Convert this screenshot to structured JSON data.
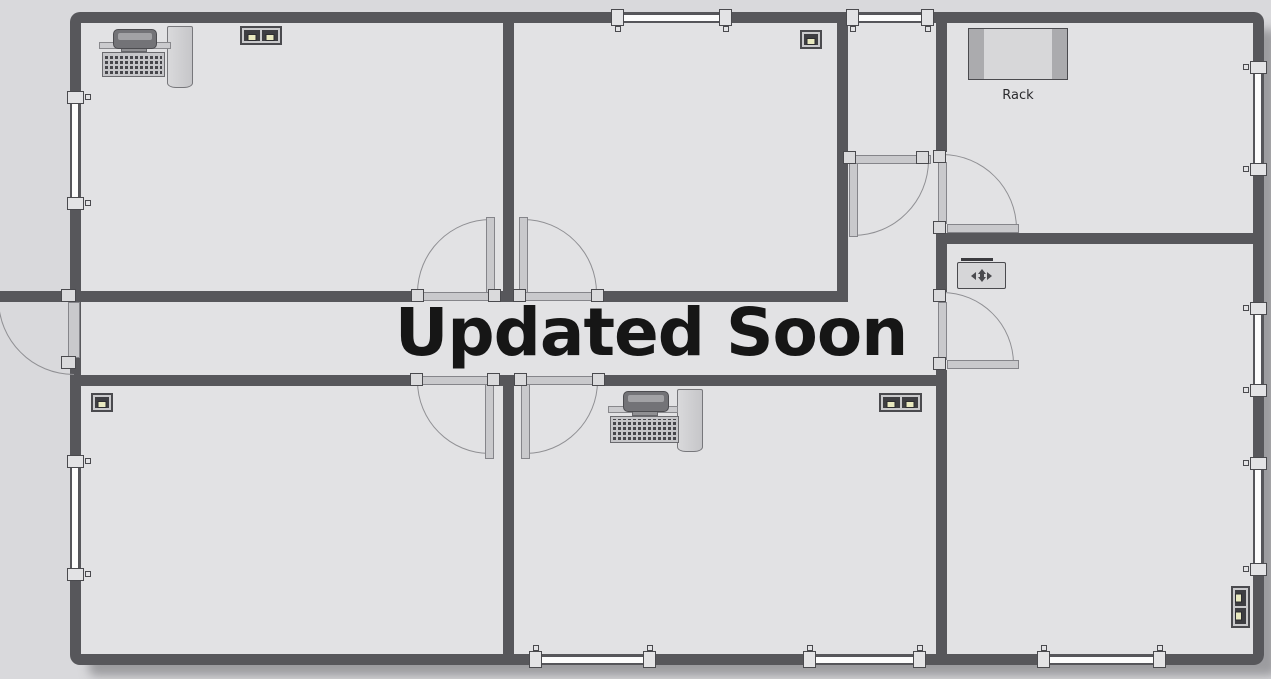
{
  "overlay": {
    "text": "Updated Soon"
  },
  "rack": {
    "label": "Rack"
  },
  "colors": {
    "bg_outside": "#d9d9dc",
    "floor": "#e2e2e4",
    "wall": "#57575b",
    "door_fill": "#c9c9cc",
    "door_outline": "#85858a",
    "outline": "#4a4a4e",
    "arc": "#909094",
    "connector_fill": "#dadadc",
    "window_fill": "#fdfdfd",
    "jack_yellow": "#e9e9c0",
    "icon_dark": "#3e3e42",
    "text_dark": "#161616"
  },
  "plan": {
    "rooms": [
      "top-left-office",
      "top-middle-office",
      "vestibule",
      "lobby",
      "server-room",
      "right-office",
      "corridor",
      "bottom-left-office",
      "bottom-middle-office"
    ],
    "counts": {
      "doors": 8,
      "windows": 10
    },
    "icons": [
      {
        "name": "workstation",
        "room": "top-left-office"
      },
      {
        "name": "network-jack-double-icon",
        "room": "top-left-office"
      },
      {
        "name": "network-jack-single-icon",
        "room": "top-middle-office"
      },
      {
        "name": "rack",
        "room": "server-room",
        "label": "Rack"
      },
      {
        "name": "junction-box-icon",
        "room": "right-office"
      },
      {
        "name": "network-jack-single-icon",
        "room": "bottom-left-office"
      },
      {
        "name": "workstation",
        "room": "bottom-middle-office"
      },
      {
        "name": "network-jack-double-icon",
        "room": "bottom-middle-office"
      },
      {
        "name": "network-jack-double-vertical-icon",
        "room": "right-office"
      }
    ]
  }
}
